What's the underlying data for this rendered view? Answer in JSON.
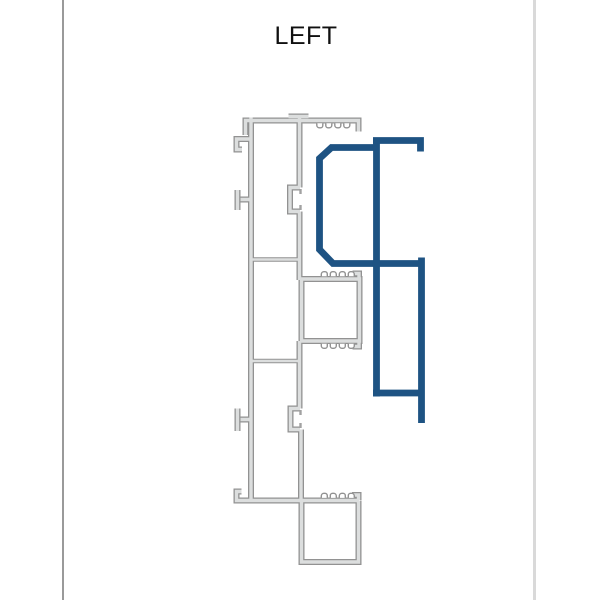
{
  "title": "LEFT",
  "colors": {
    "background": "#ffffff",
    "title_color": "#101010",
    "page_border_left": "#9a9a9a",
    "page_border_right": "#d9d9d9",
    "profile_gray_outline": "#929292",
    "profile_gray_fill": "#dcdede",
    "profile_blue": "#1e5383",
    "slot_fill": "#ffffff"
  },
  "profiles": [
    {
      "id": "frame-profile",
      "color_role": "profile_gray_outline"
    },
    {
      "id": "highlighted-profile",
      "color_role": "profile_blue"
    }
  ],
  "diagram": {
    "gray_main": "M 245.5,135 V 120.5 H 358.5 V 131.5 M 288.5,116.5 H 308.5 M 251,117.5 V 500 M 252,139 H 236.5 V 149.5 H 242 M 252,199.5 H 240.5 M 237.5,190 V 210 M 252,419.5 H 240.5 M 237.5,408.5 V 431 M 241.5,491.5 H 236.5 V 500.5 H 359 M 299.5,117.5 V 187.5 M 300,187.5 H 290 V 211.5 H 300 M 299.5,211.5 V 280 M 301.5,279 H 359.5 V 341 H 301.5 Z M 359,279.5 V 273.5 H 352.5 M 359,340.5 V 346.5 H 352.5 M 299.5,341 V 408.5 M 300,408.5 H 290.5 V 429.5 H 300 M 301,429.5 V 500.5 M 301.5,500.5 V 562 H 358.5 V 500.5 M 358.5,500 V 495 H 352",
    "gray_dividers": "M 252,259.5 H 299 M 252,361 H 299",
    "gray_ticks": "M 300.5,189 V 194 M 300.5,205 V 210 M 300.5,410 V 415 M 300.5,423 V 428",
    "gray_slots": "M 316.8,123.2 v 2 a 2.6,2.6 0 0 0 2.6,2.6 h 1.2 a 2.2,2.2 0 0 0 2.2,-2.2 v -2.4 m 3,0 v 2.4 a 2.2,2.2 0 0 0 2.2,2.2 h 1.2 a 2.6,2.6 0 0 0 2.6,-2.6 v -2 M 334.8,123.2 v 2 a 2.6,2.6 0 0 0 2.6,2.6 h 1.2 a 2.2,2.2 0 0 0 2.2,-2.2 v -2.4 m 3,0 v 2.4 a 2.2,2.2 0 0 0 2.2,2.2 h 1.2 a 2.6,2.6 0 0 0 2.6,-2.6 v -2 M 321.3,276.3 v -2 a 2.6,2.6 0 0 1 2.6,-2.6 h 1.2 a 2.2,2.2 0 0 1 2.2,2.2 v 2.4 m 3,0 v -2.4 a 2.2,2.2 0 0 1 2.2,-2.2 h 1.2 a 2.6,2.6 0 0 1 2.6,2.6 v 2 M 339.3,276.3 v -2 a 2.6,2.6 0 0 1 2.6,-2.6 h 1.2 a 2.2,2.2 0 0 1 2.2,2.2 v 2.4 m 3,0 v -2.4 a 2.2,2.2 0 0 1 2.2,-2.2 h 1.2 a 2.6,2.6 0 0 1 2.6,2.6 v 2 M 321.3,343.7 v 2 a 2.6,2.6 0 0 0 2.6,2.6 h 1.2 a 2.2,2.2 0 0 0 2.2,-2.2 v -2.4 m 3,0 v 2.4 a 2.2,2.2 0 0 0 2.2,2.2 h 1.2 a 2.6,2.6 0 0 0 2.6,-2.6 v -2 M 339.3,343.7 v 2 a 2.6,2.6 0 0 0 2.6,2.6 h 1.2 a 2.2,2.2 0 0 0 2.2,-2.2 v -2.4 m 3,0 v 2.4 a 2.2,2.2 0 0 0 2.2,2.2 h 1.2 a 2.6,2.6 0 0 0 2.6,-2.6 v -2 M 321.3,497.9 v -2 a 2.6,2.6 0 0 1 2.6,-2.6 h 1.2 a 2.2,2.2 0 0 1 2.2,2.2 v 2.4 m 3,0 v -2.4 a 2.2,2.2 0 0 1 2.2,-2.2 h 1.2 a 2.6,2.6 0 0 1 2.6,2.6 v 2 M 339.3,497.9 v -2 a 2.6,2.6 0 0 1 2.6,-2.6 h 1.2 a 2.2,2.2 0 0 1 2.2,2.2 v 2.4 m 3,0 v -2.4 a 2.2,2.2 0 0 1 2.2,-2.2 h 1.2 a 2.6,2.6 0 0 1 2.6,2.6 v 2",
    "blue_clamp": "M 378,147.5 H 331.5 L 319.5,158.5 V 249.5 L 333,263.5 H 378",
    "blue_frame": "M 376.5,137.5 V 396.5 M 373,140.5 H 420.5 V 151.5 M 373,263.5 H 421.5 M 421.5,257.5 V 423 M 373,393 H 424.5"
  }
}
